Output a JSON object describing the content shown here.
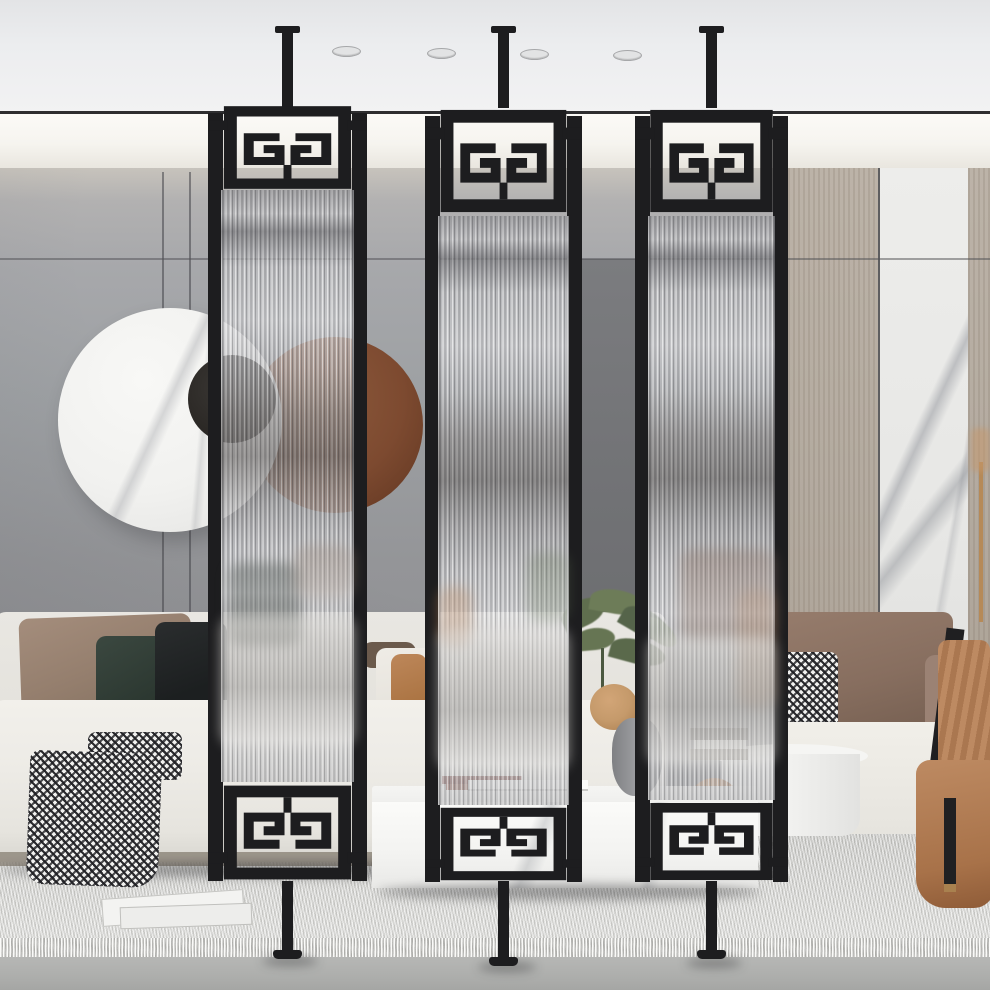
{
  "meta": {
    "domain": "natural-image",
    "description": "Product lifestyle photo: modern living room with three floor-to-ceiling black metal room divider screens with fluted reeded glass and Greek key meander ornaments, tension-mounted between ceiling and floor"
  },
  "scene": {
    "screens": {
      "count": 3,
      "material": "black metal frame with fluted glass",
      "ornament": "greek-key-meander top and bottom",
      "mounting": "ceiling-to-floor tension poles with T-caps and feet"
    },
    "ceiling": {
      "recessed_lights": 4,
      "cove_shadow_line": true
    },
    "wall": {
      "left": "gray paneled wall with vertical and horizontal seams",
      "accent_stripe": "dark gray vertical band between screens 2 and 3",
      "right": "greige wood panel and white marble slab panel"
    },
    "wall_art": {
      "pieces": [
        "white marble disc",
        "dark walnut disc",
        "charcoal center disc"
      ]
    },
    "furniture": [
      "white modular sofa",
      "taupe pillow",
      "dark green velvet pillow",
      "black pillow",
      "rust orange pillow",
      "white pillows",
      "black-white houndstooth throw blanket",
      "white marble coffee table",
      "red books",
      "white tray",
      "green potted plant",
      "tan round vase",
      "gray ceramic vase",
      "white drum side table",
      "book stack",
      "copper sphere",
      "taupe leather armchair",
      "brown pillow",
      "houndstooth pillow",
      "black frame chair with camel throw",
      "gray fringed area rug",
      "magazines on rug"
    ]
  },
  "palette": {
    "frame": "#1d1d1f",
    "ceiling": "#ecedef",
    "line": "#2e2e30",
    "cove": "#f6f4ef",
    "wallA": "#c7c3bc",
    "wallB": "#a4a5a8",
    "wallC": "#8b8c90",
    "stripe": "#747578",
    "wood": "#b5ac9f",
    "marble": "#eaeae8",
    "rug": "#d5d5d2",
    "floor": "#b1b2b0",
    "sofa": "#efede8",
    "taupe": "#97816f",
    "green": "#303c34",
    "pblack": "#1e2122",
    "rust": "#b27a4e",
    "brown": "#8a7062",
    "camel": "#b5825c",
    "discW": "#f3f3f1",
    "discB": "#7d4a30",
    "discD": "#2c2926",
    "plant": "#5f6e4e",
    "copper": "#b07a4f",
    "tableW": "#f7f7f5"
  }
}
